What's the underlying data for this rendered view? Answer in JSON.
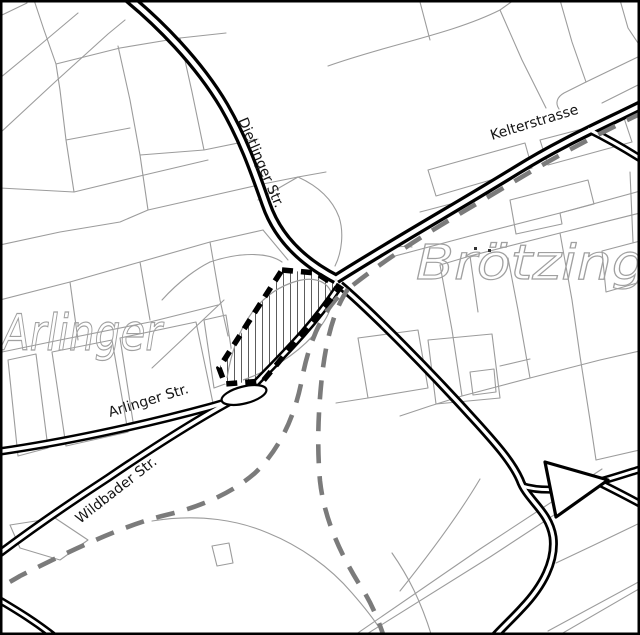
{
  "map": {
    "colors": {
      "background": "#ffffff",
      "road": "#000000",
      "parcel": "#9c9c9c",
      "planned_route": "#7b7b7b",
      "plan_border": "#000000",
      "hatch": "#4a4a4a",
      "region_label": "#a0a0a0",
      "label": "#141414",
      "frame": "#000000"
    },
    "region_labels": [
      {
        "id": "arlinger",
        "text": "Arlinger"
      },
      {
        "id": "broetzingen",
        "text": "Brötzingen"
      }
    ],
    "street_labels": [
      {
        "id": "dietlinger-str",
        "text": "Dietlinger Str."
      },
      {
        "id": "kelterstrasse",
        "text": "Kelterstrasse"
      },
      {
        "id": "arlinger-str",
        "text": "Arlinger Str."
      },
      {
        "id": "wildbader-str",
        "text": "Wildbader Str."
      }
    ]
  }
}
